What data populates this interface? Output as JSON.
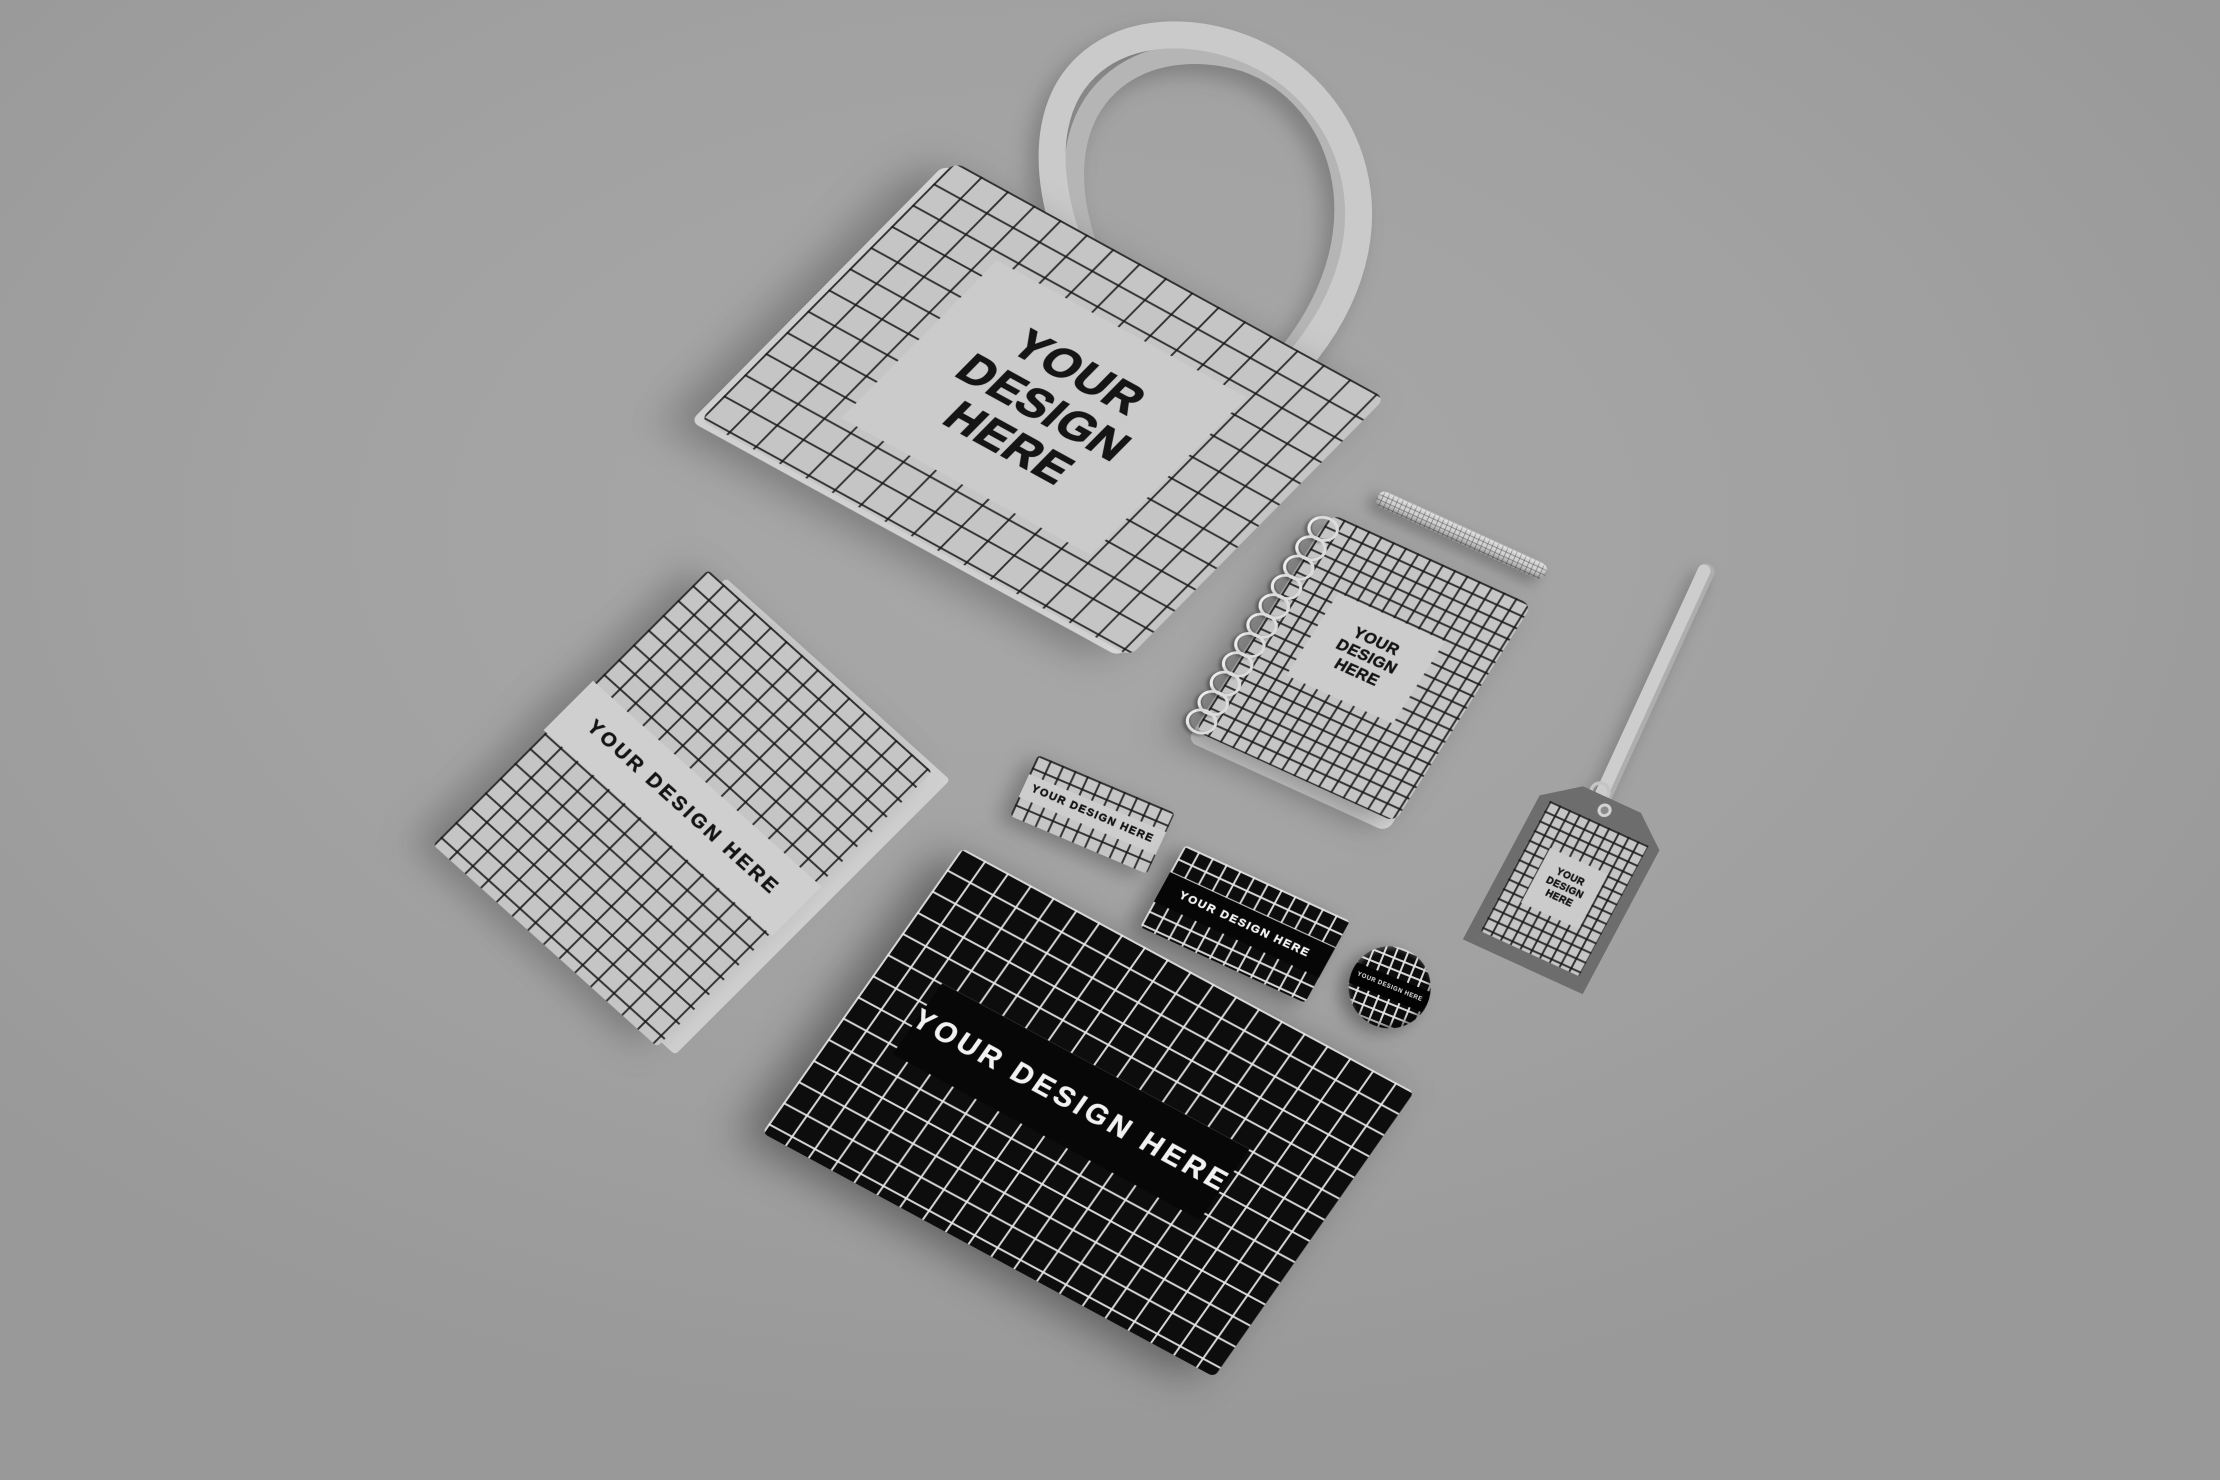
{
  "scene": {
    "background_color": "#a2a2a2",
    "placeholder_full": "YOUR DESIGN HERE"
  },
  "colors": {
    "light_surface": "#c5c5c5",
    "light_panel": "#cbcbcb",
    "dark_surface": "#0d0d0d",
    "dark_band": "#060606",
    "grid_lines_on_light": "#181818",
    "grid_lines_on_dark": "#e8e8e8",
    "text_on_light": "#141414",
    "text_on_dark": "#f4f4f4",
    "strap": "#c9c9c9",
    "tag_frame": "#6d6d6d"
  },
  "items": {
    "tote_bag": {
      "lines": [
        "YOUR",
        "DESIGN",
        "HERE"
      ]
    },
    "letterhead": {
      "label": "YOUR DESIGN HERE"
    },
    "spiral_notebook": {
      "lines": [
        "YOUR",
        "DESIGN",
        "HERE"
      ]
    },
    "business_card_light": {
      "label": "YOUR DESIGN HERE"
    },
    "business_card_dark": {
      "label": "YOUR DESIGN HERE"
    },
    "envelope_dark": {
      "label": "YOUR DESIGN HERE"
    },
    "badge_pin": {
      "label": "YOUR DESIGN HERE"
    },
    "id_tag": {
      "lines": [
        "YOUR",
        "DESIGN",
        "HERE"
      ]
    }
  }
}
